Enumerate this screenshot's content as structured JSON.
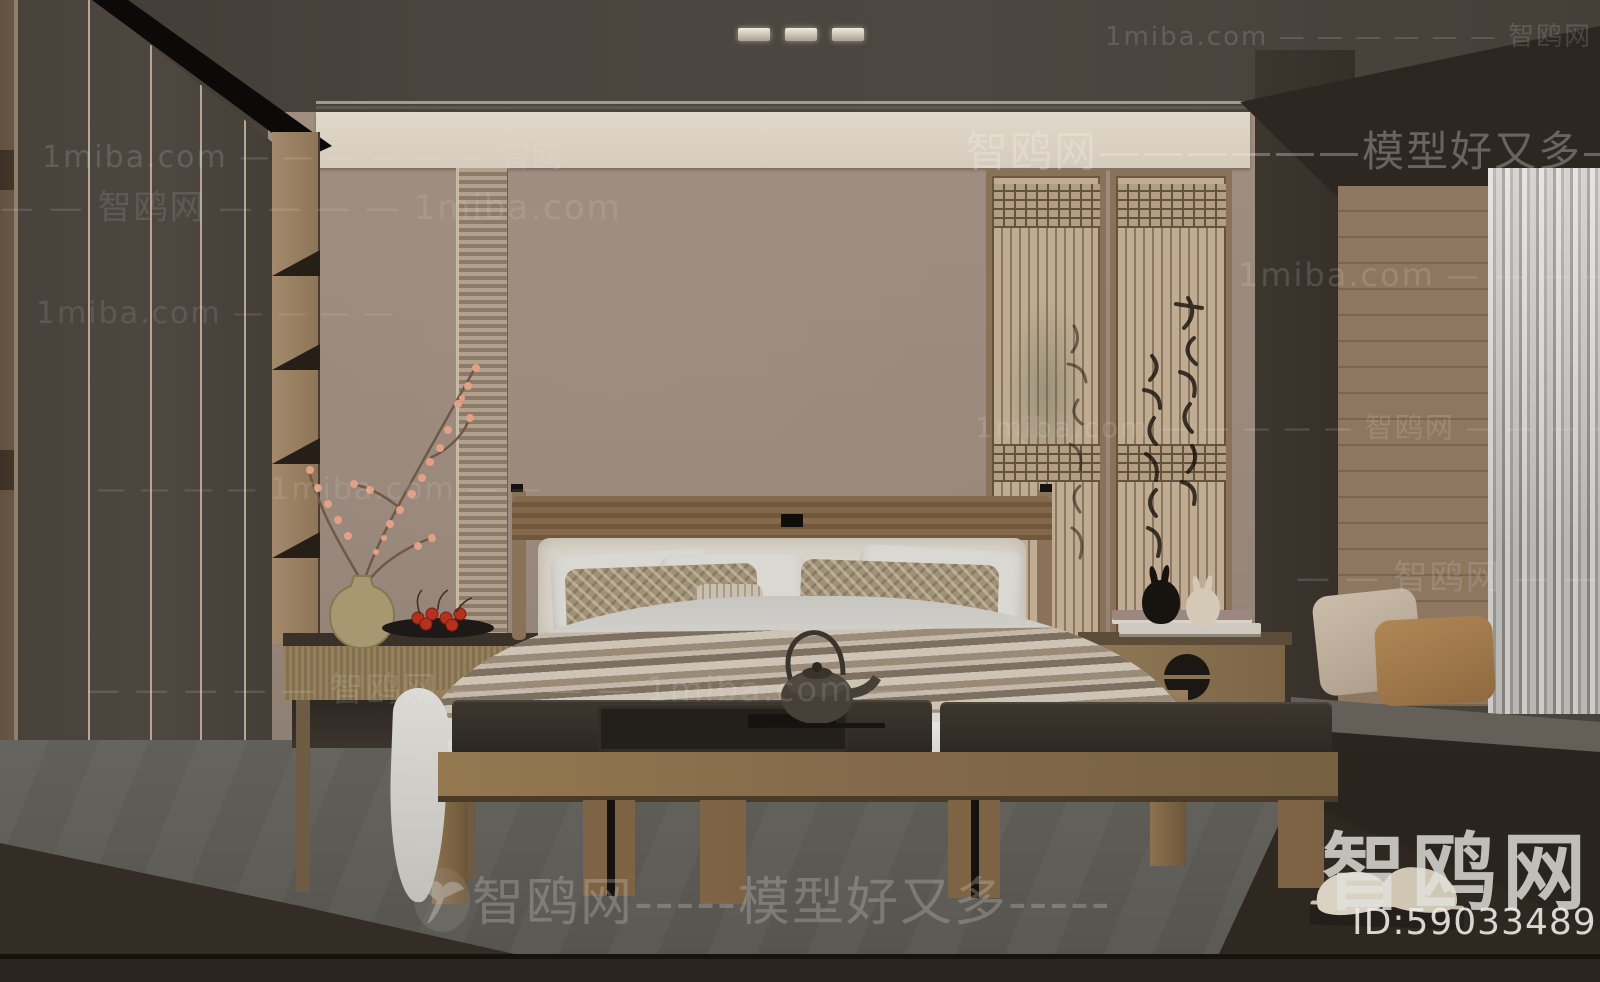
{
  "site": {
    "name": "智鸥网",
    "partner_site": "1miba.com",
    "tagline": "模型好又多",
    "model_id": "ID:590334891"
  },
  "watermarks": {
    "top_right": "1miba.com — — — — — — 智鸥网 — — — — —",
    "wall_band": "智鸥网——————模型好又多————",
    "left_row1": "1miba.com — — — — — — 智鸥",
    "left_row2": "— — 智鸥网 — — — — 1miba.com",
    "left_row3": "1miba.com — — — —",
    "center_row": "— — — — 1miba.com — —",
    "right_row1": "1miba.com — — — — — — 智鸥网 —",
    "right_row2": "1miba.com — — — — — 智鸥网 — — — — — 1miba.com",
    "right_row3": "— — 智鸥网 — — —",
    "lower_left_row": "— — — — — 智鸥网 — — — — 1miba.com — —",
    "bottom_center": "智鸥网-----模型好又多-----",
    "logo_text": "智鸥网",
    "id_text": "ID:590334891"
  },
  "colors": {
    "ceiling": "#4a453e",
    "back_wall": "#9c8b7c",
    "cove_band": "#d9d0c1",
    "wood_frame": "#8a7258",
    "wardrobe": "#4a433c",
    "carpet": "#5b5953",
    "accent_berry": "#b5301f",
    "pillow_caramel": "#a67c4e"
  }
}
